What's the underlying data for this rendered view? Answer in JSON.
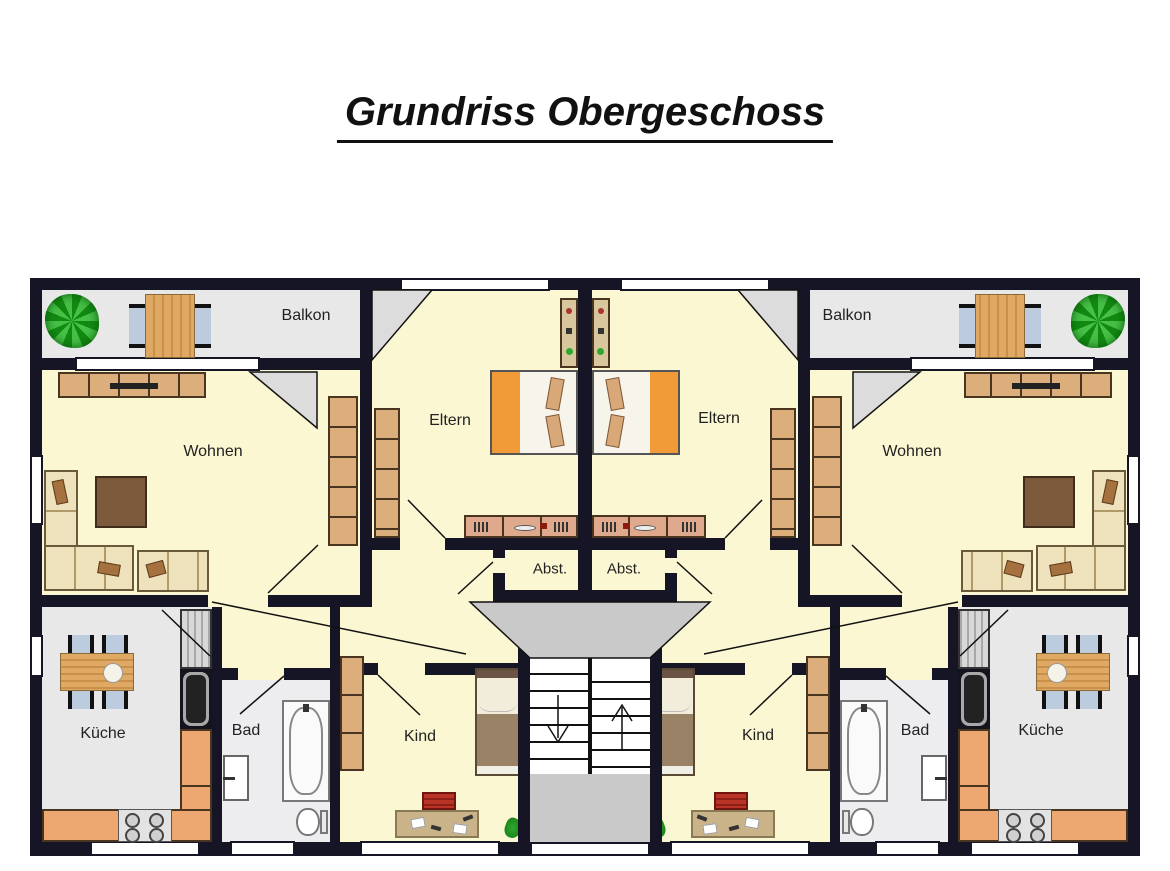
{
  "title": "Grundriss Obergeschoss",
  "apartments": {
    "left": {
      "balkon": "Balkon",
      "wohnen": "Wohnen",
      "eltern": "Eltern",
      "abstellraum": "Abst.",
      "kueche": "Küche",
      "bad": "Bad",
      "kind": "Kind"
    },
    "right": {
      "balkon": "Balkon",
      "wohnen": "Wohnen",
      "eltern": "Eltern",
      "abstellraum": "Abst.",
      "kueche": "Küche",
      "bad": "Bad",
      "kind": "Kind"
    }
  },
  "stairs": {
    "down_arrow": "down",
    "up_arrow": "up"
  },
  "colors": {
    "wall": "#151525",
    "room_floor": "#FBF7D2",
    "balcony_floor": "#E8E8E8",
    "bath_floor": "#EDEDF0",
    "landing_gray": "#C9C9C9",
    "wood": "#DFA964",
    "cabinet_tan": "#DCAE7C",
    "counter_orange": "#EDA871",
    "sofa_beige": "#EDE2BC",
    "coffee_table_brown": "#7E5A3C",
    "bed_orange": "#F09A38",
    "chair_blue": "#BCCBDE",
    "desk_chair_red": "#B93326",
    "plant_green": "#2fa82f"
  }
}
